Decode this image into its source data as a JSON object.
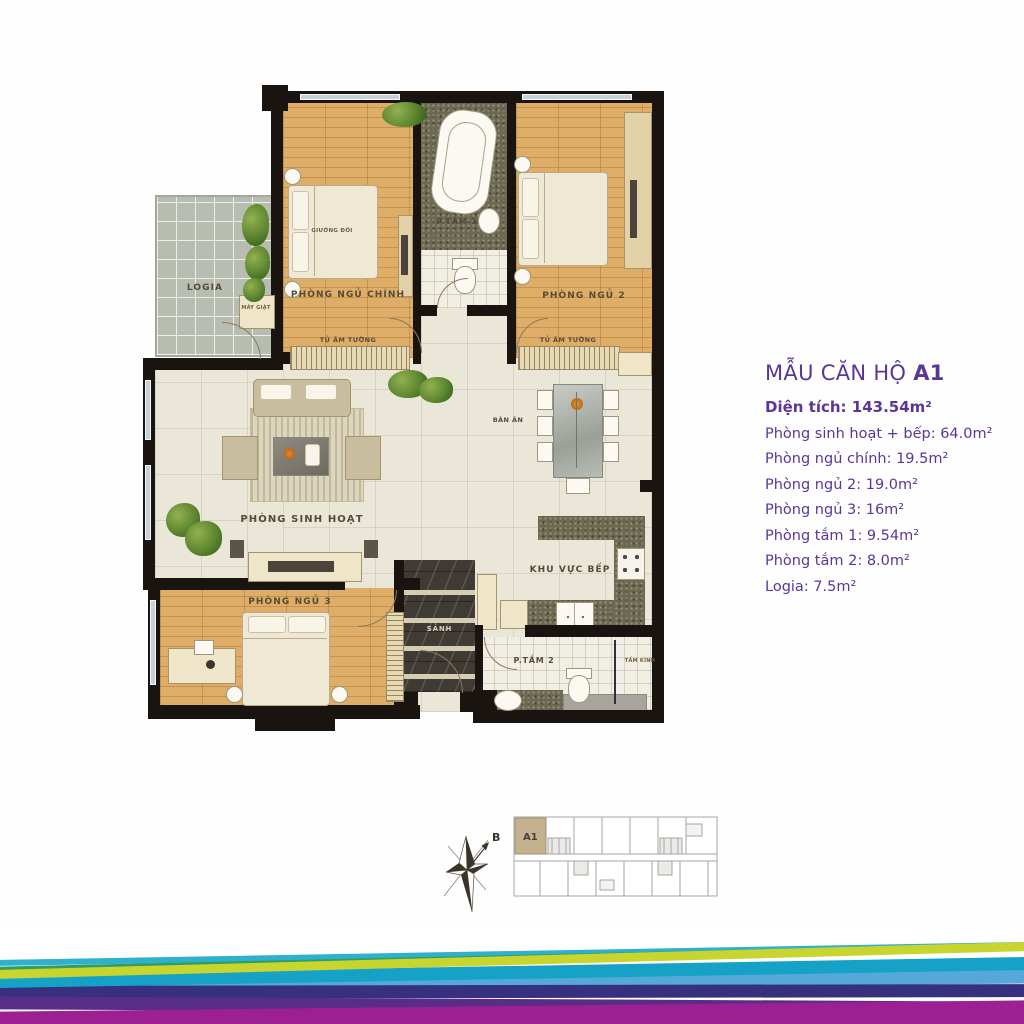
{
  "info": {
    "title_prefix": "MẪU CĂN HỘ",
    "title_unit": "A1",
    "lines": [
      {
        "text": "Diện tích: 143.54m²"
      },
      {
        "text": "Phòng sinh hoạt + bếp: 64.0m²"
      },
      {
        "text": "Phòng ngủ chính: 19.5m²"
      },
      {
        "text": "Phòng ngủ 2: 19.0m²"
      },
      {
        "text": "Phòng ngủ 3: 16m²"
      },
      {
        "text": "Phòng tắm 1: 9.54m²"
      },
      {
        "text": "Phòng tắm 2: 8.0m²"
      },
      {
        "text": "Logia: 7.5m²"
      }
    ]
  },
  "plan": {
    "labels": {
      "logia": "LOGIA",
      "washing_machine": "MÁY GIẶT",
      "master_bedroom": "PHÒNG NGỦ CHÍNH",
      "double_bed": "GIƯỜNG ĐÔI",
      "bathroom1": "P.TẮM 1",
      "bedroom2": "PHÒNG NGỦ 2",
      "wardrobe1": "TỦ ÂM TƯỜNG",
      "wardrobe2": "TỦ ÂM TƯỜNG",
      "living_room": "PHÒNG SINH HOẠT",
      "dining_table": "BÀN ĂN",
      "kitchen": "KHU VỰC BẾP",
      "bedroom3": "PHÒNG NGỦ 3",
      "hall": "SẢNH",
      "bathroom2": "P.TẮM 2",
      "glass_panel": "TẤM KÍNH"
    }
  },
  "compass": {
    "north_label": "B"
  },
  "keyplan": {
    "unit_label": "A1",
    "highlight_color": "#c4b190"
  },
  "colors": {
    "accent_purple": "#5b3699",
    "wall": "#1a1410",
    "wood_floor": "#d8a45a",
    "stripe_lime": "#c9d52f",
    "stripe_green": "#2f9e63",
    "stripe_cyan_thin": "#2fb0cf",
    "stripe_cyan": "#16a2c6",
    "stripe_lightblue": "#55a9d9",
    "stripe_indigo": "#36307f",
    "stripe_purple": "#572d87",
    "stripe_magenta": "#9d2092"
  }
}
